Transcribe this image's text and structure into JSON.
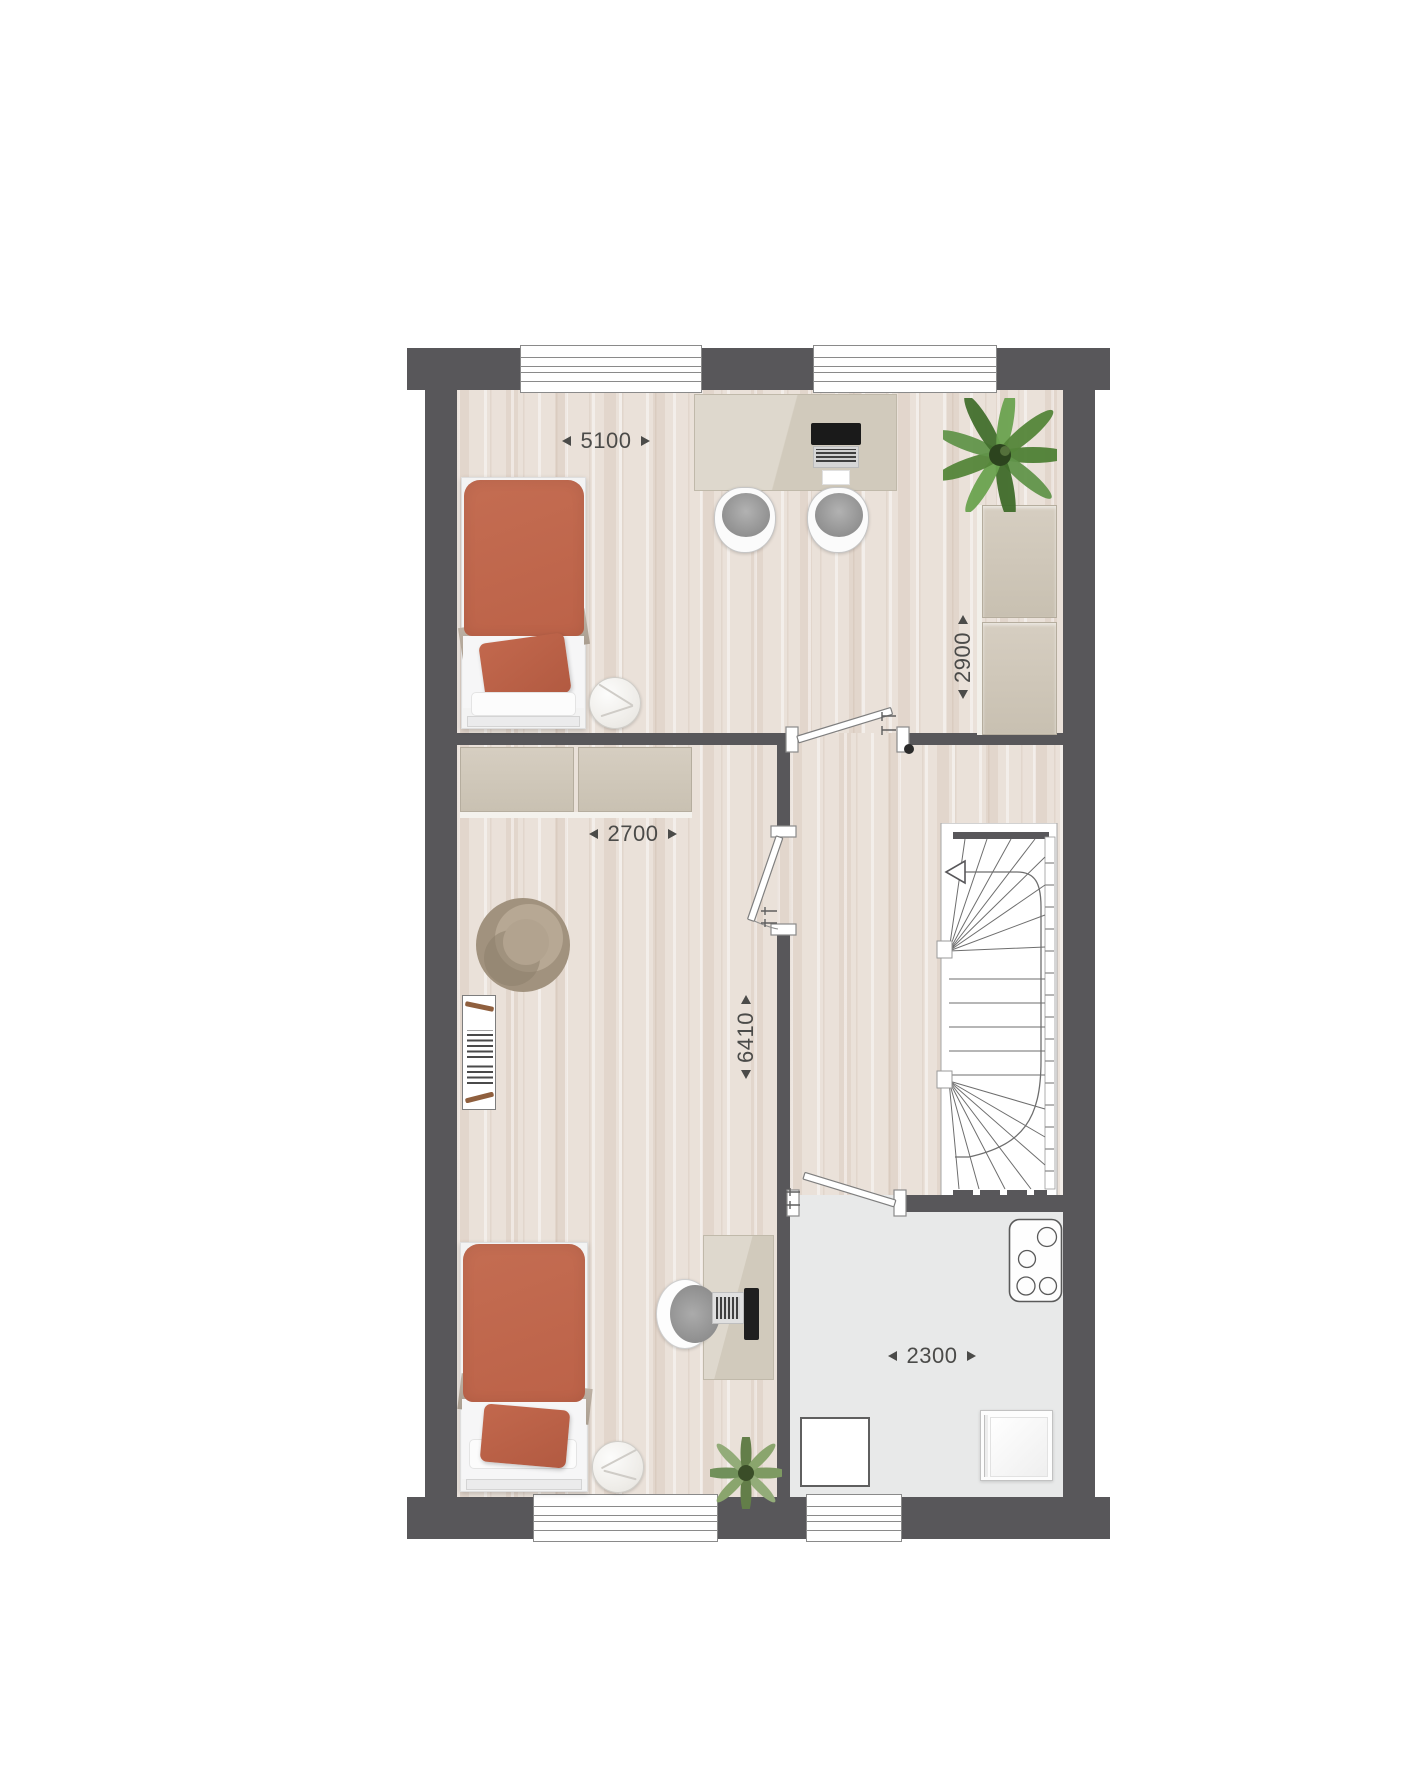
{
  "document": {
    "type": "architectural-floor-plan",
    "view": "top-down"
  },
  "dimension_labels": {
    "top_room_width": "5100",
    "right_wardrobe_height": "2900",
    "middle_room_width": "2700",
    "rooms_depth": "6410",
    "bathroom_width": "2300"
  },
  "colors": {
    "wall": "#58575a",
    "wood_floor": "#eae1d9",
    "bathroom_floor": "#e8e9e9",
    "terracotta_bedding": "#c0684e",
    "beige_furniture": "#d3ccbf",
    "plant_green": "#5a8c3f",
    "label_text": "#4b4b49",
    "background": "#ffffff"
  },
  "icons": [
    "single-bed-icon",
    "side-table-icon",
    "desk-icon",
    "laptop-icon",
    "monitor-icon",
    "desk-chair-icon",
    "plant-icon",
    "wardrobe-icon",
    "armchair-icon",
    "bookshelf-icon",
    "stairs-icon",
    "door-icon",
    "window-icon",
    "shower-tray-icon",
    "washing-machine-icon",
    "radiator-icon"
  ]
}
